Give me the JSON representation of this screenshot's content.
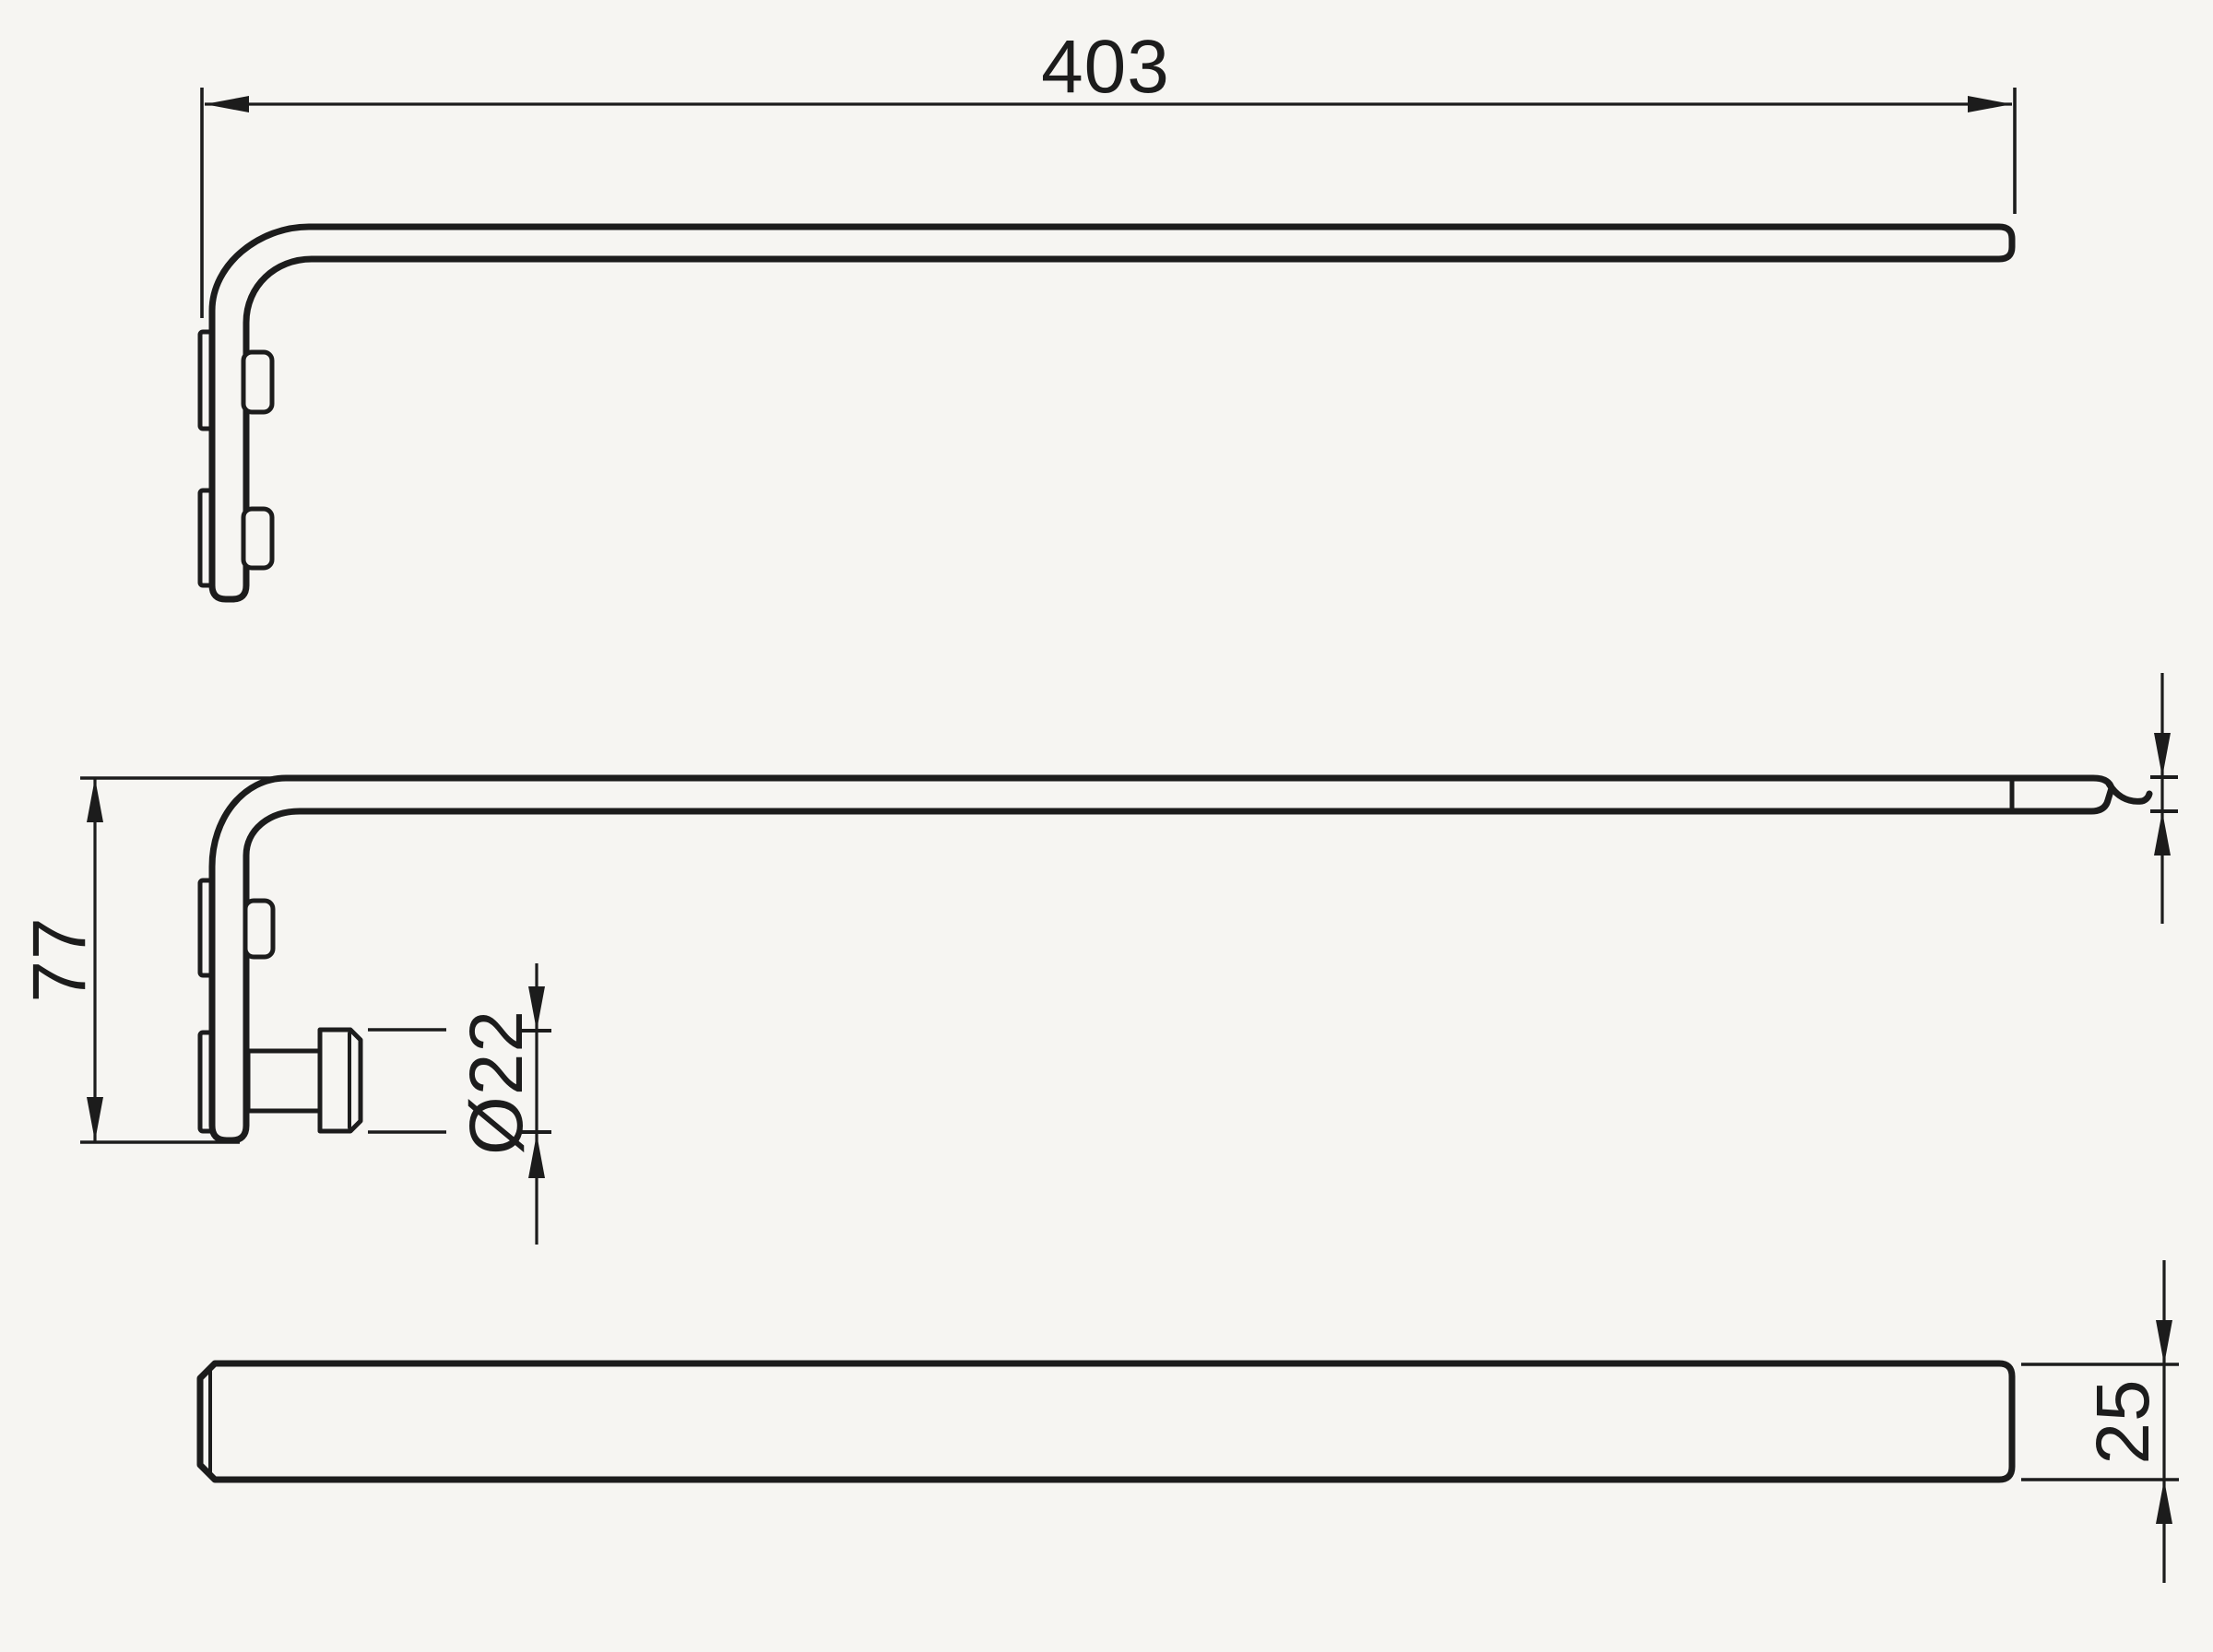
{
  "colors": {
    "background": "#f6f5f2",
    "line": "#1c1c1c"
  },
  "dimensions": {
    "length": "403",
    "mount_height": "77",
    "hook_diameter": "Ø22",
    "bar_width": "25"
  }
}
